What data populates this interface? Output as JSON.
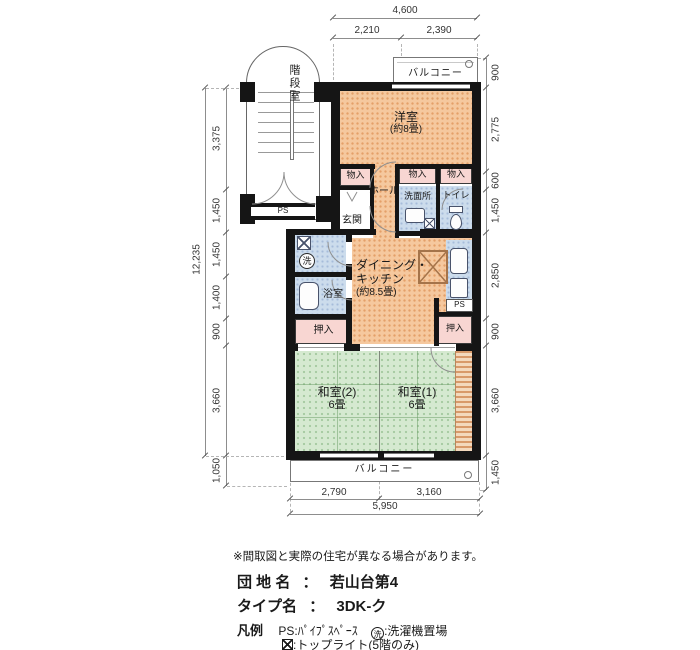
{
  "dims": {
    "top_overall": "4,600",
    "top_parts": [
      "2,210",
      "2,390"
    ],
    "left_overall": "12,235",
    "left_parts": [
      "3,375",
      "1,450",
      "1,450",
      "1,400",
      "900",
      "3,660",
      "1,050"
    ],
    "right_parts": [
      "900",
      "2,775",
      "600",
      "1,450",
      "2,850",
      "900",
      "3,660",
      "1,450"
    ],
    "bottom_parts": [
      "2,790",
      "3,160"
    ],
    "bottom_overall": "5,950"
  },
  "rooms": {
    "stairwell": "階段室",
    "balcony": "バルコニー",
    "western": {
      "name": "洋室",
      "size": "(約8畳)"
    },
    "closet": "物入",
    "hall": "ホール",
    "entrance": "玄関",
    "washroom": "洗面所",
    "toilet": "トイレ",
    "ps": "PS",
    "wash_mark": "洗",
    "bath": "浴室",
    "dk": {
      "line1": "ダイニング・",
      "line2": "キッチン",
      "size": "(約8.5畳)"
    },
    "oshiire": "押入",
    "washitsu2": {
      "name": "和室(2)",
      "size": "6畳"
    },
    "washitsu1": {
      "name": "和室(1)",
      "size": "6畳"
    }
  },
  "footer": {
    "note": "※間取図と実際の住宅が異なる場合があります。",
    "estate_label": "団 地 名",
    "estate_colon": "：",
    "estate_value": "若山台第4",
    "type_label": "タイプ名",
    "type_colon": "：",
    "type_value": "3DK-ク",
    "legend_title": "凡例",
    "legend": [
      {
        "symbol": "PS",
        "desc": ":ﾊﾟｲﾌﾟｽﾍﾟｰｽ"
      },
      {
        "symbol": "洗",
        "desc": ":洗濯機置場"
      },
      {
        "symbol": "⊠",
        "desc": ":トップライト(5階のみ)"
      }
    ]
  },
  "colors": {
    "wall": "#151515",
    "room_orange": "#f5c89e",
    "room_green": "#d5e9d0",
    "closet_pink": "#f8d6d2",
    "water_blue": "#ccdcec"
  }
}
